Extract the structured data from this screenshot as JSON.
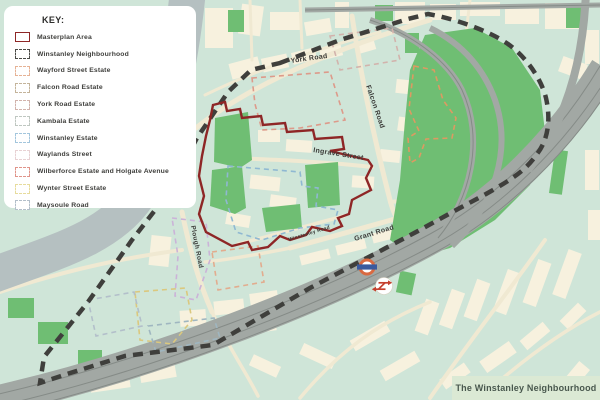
{
  "legend": {
    "title": "KEY:",
    "items": [
      {
        "id": "masterplan-area",
        "label": "Masterplan Area",
        "color": "#8e2626",
        "style": "solid"
      },
      {
        "id": "winstanley-neighbourhood",
        "label": "Winstanley Neighbourhood",
        "color": "#4a4a46",
        "style": "dashed"
      },
      {
        "id": "wayford-street-estate",
        "label": "Wayford Street Estate",
        "color": "#e6b295",
        "style": "dashed"
      },
      {
        "id": "falcon-road-estate",
        "label": "Falcon Road Estate",
        "color": "#c4b49b",
        "style": "dashed"
      },
      {
        "id": "york-road-estate",
        "label": "York Road Estate",
        "color": "#d2b3ac",
        "style": "dashed"
      },
      {
        "id": "kambala-estate",
        "label": "Kambala Estate",
        "color": "#bfc7c1",
        "style": "dashed"
      },
      {
        "id": "winstanley-estate",
        "label": "Winstanley Estate",
        "color": "#a3c6dd",
        "style": "dashed"
      },
      {
        "id": "waylands-street",
        "label": "Waylands Street",
        "color": "#e8d2d4",
        "style": "dashed"
      },
      {
        "id": "wilberforce-estate-and-holgate-avenue",
        "label": "Wilberforce Estate and Holgate Avenue",
        "color": "#e0948a",
        "style": "dashed"
      },
      {
        "id": "wynter-street-estate",
        "label": "Wynter Street Estate",
        "color": "#e7dc9d",
        "style": "dashed"
      },
      {
        "id": "maysoule-road",
        "label": "Maysoule Road",
        "color": "#b3bfca",
        "style": "dashed"
      }
    ]
  },
  "map": {
    "caption": "The Winstanley Neighbourhood",
    "road_labels": [
      {
        "id": "york-road",
        "text": "York Road",
        "x": 291,
        "y": 63,
        "rot": -8,
        "size": 7
      },
      {
        "id": "falcon-road",
        "text": "Falcon Road",
        "x": 366,
        "y": 86,
        "rot": 71,
        "size": 7
      },
      {
        "id": "ingrave-street",
        "text": "Ingrave Street",
        "x": 313,
        "y": 152,
        "rot": 9,
        "size": 7
      },
      {
        "id": "grant-road",
        "text": "Grant Road",
        "x": 355,
        "y": 241,
        "rot": -17,
        "size": 7
      },
      {
        "id": "winstanley-road",
        "text": "Winstanley Road",
        "x": 289,
        "y": 241,
        "rot": -17,
        "size": 4.8
      },
      {
        "id": "plough-road",
        "text": "Plough Road",
        "x": 191,
        "y": 226,
        "rot": 79,
        "size": 6.5
      }
    ],
    "station_icons": [
      {
        "id": "overground-roundel-icon"
      },
      {
        "id": "national-rail-icon"
      }
    ]
  },
  "palette": {
    "background": "#cfe5d8",
    "blocks": "#f7f1de",
    "roads": "#f0e9d2",
    "park": "#6fbe73",
    "river": "#b5c0c1",
    "railway": "#a2a8a4",
    "masterplan_red": "#8e2626",
    "boundary_black": "#3f3f3c",
    "caption_bg": "#dbe9d4",
    "caption_text": "#49584e",
    "roundel_ring": "#d96a41",
    "roundel_bar": "#3a5a9e",
    "national_rail_red": "#c5402e"
  }
}
